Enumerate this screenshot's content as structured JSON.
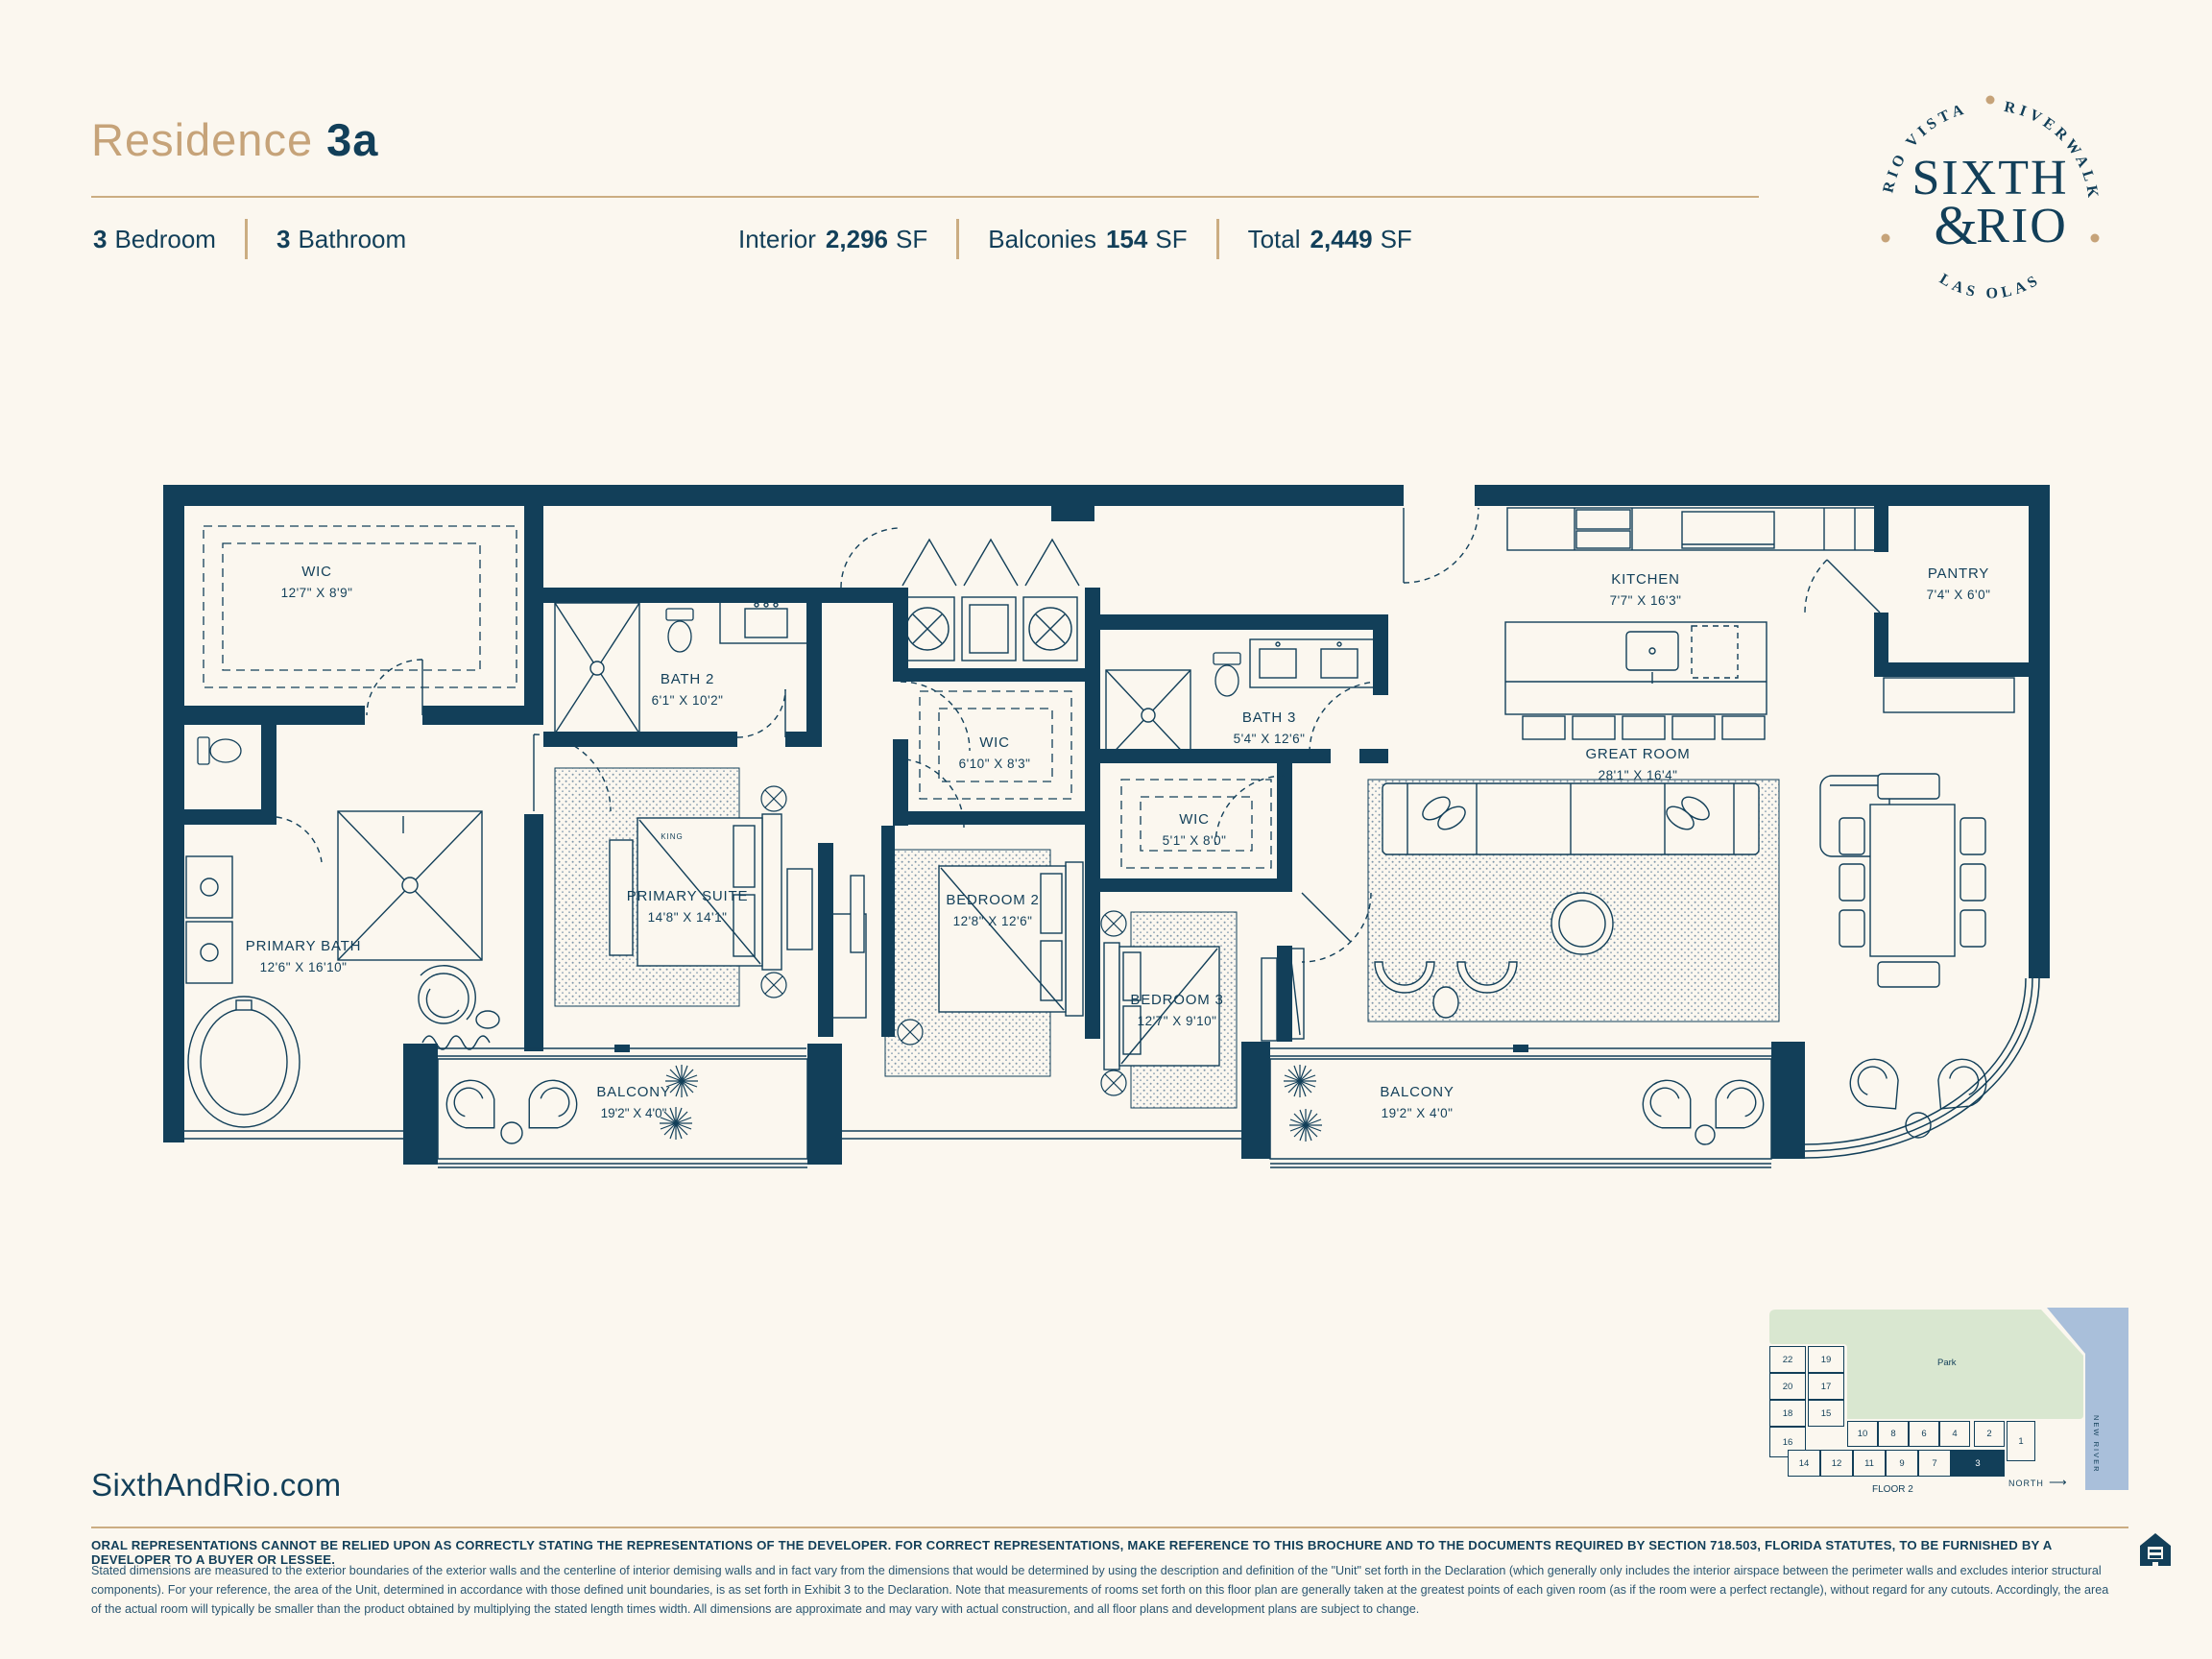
{
  "page": {
    "title_prefix": "Residence",
    "title_unit": "3a",
    "website": "SixthAndRio.com"
  },
  "specs": {
    "bedrooms_value": "3",
    "bedrooms_label": "Bedroom",
    "bathrooms_value": "3",
    "bathrooms_label": "Bathroom",
    "interior_label": "Interior",
    "interior_value": "2,296",
    "interior_unit": "SF",
    "balconies_label": "Balconies",
    "balconies_value": "154",
    "balconies_unit": "SF",
    "total_label": "Total",
    "total_value": "2,449",
    "total_unit": "SF"
  },
  "logo": {
    "arc_left": "RIO VISTA",
    "arc_right": "RIVERWALK",
    "arc_bottom": "LAS OLAS",
    "name1": "SIXTH",
    "amp": "&",
    "name2": "RIO"
  },
  "rooms": [
    {
      "name": "WIC",
      "dims": "12'7\" X 8'9\""
    },
    {
      "name": "PRIMARY BATH",
      "dims": "12'6\" X 16'10\""
    },
    {
      "name": "BATH 2",
      "dims": "6'1\" X 10'2\""
    },
    {
      "name": "PRIMARY SUITE",
      "dims": "14'8\" X 14'1\""
    },
    {
      "name": "WIC",
      "dims": "6'10\" X 8'3\""
    },
    {
      "name": "BEDROOM 2",
      "dims": "12'8\" X 12'6\""
    },
    {
      "name": "BATH 3",
      "dims": "5'4\" X 12'6\""
    },
    {
      "name": "WIC",
      "dims": "5'1\" X 8'0\""
    },
    {
      "name": "BEDROOM 3",
      "dims": "12'7\" X 9'10\""
    },
    {
      "name": "KITCHEN",
      "dims": "7'7\" X 16'3\""
    },
    {
      "name": "PANTRY",
      "dims": "7'4\" X 6'0\""
    },
    {
      "name": "GREAT ROOM",
      "dims": "28'1\" X 16'4\""
    },
    {
      "name": "BALCONY",
      "dims": "19'2\" X 4'0\""
    },
    {
      "name": "BALCONY",
      "dims": "19'2\" X 4'0\""
    }
  ],
  "plan": {
    "bed_label": "KING"
  },
  "keyplan": {
    "park": "Park",
    "river": "NEW RIVER",
    "floor": "FLOOR 2",
    "north": "NORTH",
    "col1": [
      "22",
      "20",
      "18",
      "16"
    ],
    "col2": [
      "19",
      "17",
      "15"
    ],
    "row_top": [
      "10",
      "8",
      "6",
      "4",
      "2"
    ],
    "row_bottom": [
      "14",
      "12",
      "11",
      "9",
      "7"
    ],
    "unit_highlight": "3",
    "unit_1": "1"
  },
  "disclaimer": {
    "bold_line": "ORAL REPRESENTATIONS CANNOT BE RELIED UPON AS CORRECTLY STATING THE REPRESENTATIONS OF THE DEVELOPER.  FOR CORRECT REPRESENTATIONS, MAKE REFERENCE TO THIS BROCHURE AND TO THE DOCUMENTS REQUIRED BY SECTION 718.503, FLORIDA STATUTES, TO BE FURNISHED BY A DEVELOPER TO A BUYER OR LESSEE.",
    "body": "Stated dimensions are measured to the exterior boundaries of the exterior walls and the centerline of interior demising walls and in fact vary from the dimensions that would be determined by using the description and definition of the \"Unit\" set forth in the Declaration (which generally only includes the interior airspace between the perimeter walls and excludes interior structural components). For your reference, the area of the Unit, determined in accordance with those defined unit boundaries, is as set forth in Exhibit 3 to the Declaration. Note that measurements of rooms set forth on this floor plan are generally taken at the greatest points of each given room (as if the room were a perfect rectangle), without regard for any cutouts. Accordingly, the area of the actual room will typically be smaller than the product obtained by multiplying the stated length times width. All dimensions are approximate and may vary with actual construction, and all floor plans and development plans are subject to change."
  }
}
